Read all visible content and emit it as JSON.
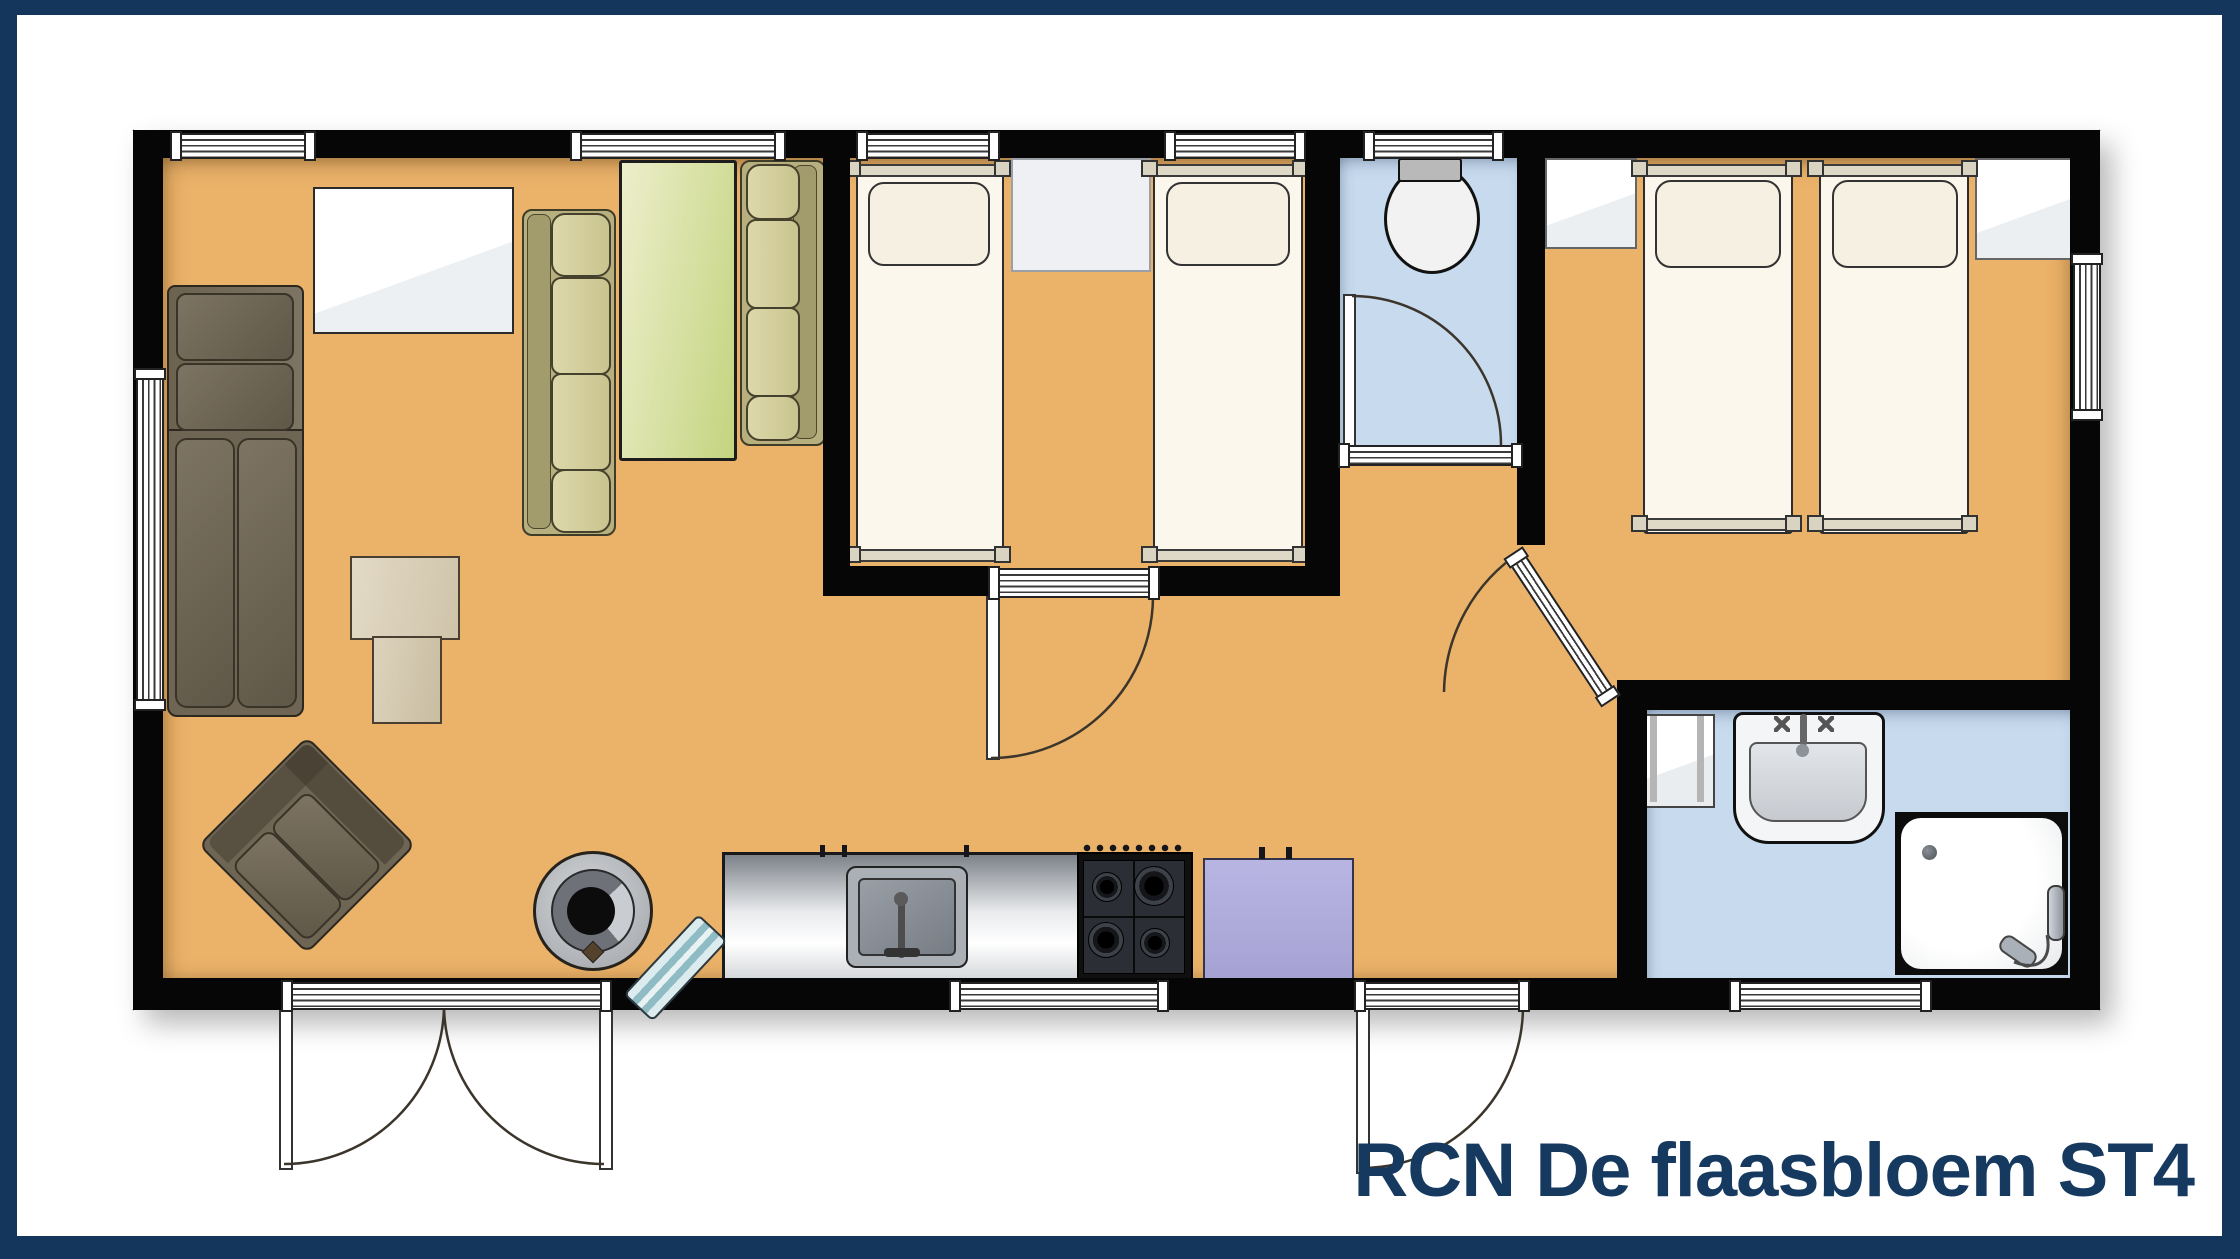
{
  "title": {
    "label": "RCN De flaasbloem ST4"
  },
  "colors": {
    "frame_navy": "#14365c",
    "title_navy": "#15395f",
    "wall_black": "#060606",
    "floor_orange": "#ebb269",
    "wetroom_blue": "#c7daee",
    "sofa_olive": "#b7b07e",
    "sofa_brown": "#6e6554",
    "dinette_green_light": "#edeecb",
    "dinette_green_dark": "#c3d47f",
    "appliance_purple": "#b9b5e3",
    "bed_white": "#fbf7ed"
  },
  "plan": {
    "type": "holiday-chalet-floor-plan",
    "rooms": [
      {
        "name": "living-room",
        "floor": "orange",
        "furniture": [
          "corner-sofa",
          "armchair",
          "coffee-table",
          "sideboard",
          "dinette-sofa",
          "dinette-table",
          "dinette-sofa",
          "wood-stove",
          "bench"
        ]
      },
      {
        "name": "kitchen",
        "floor": "orange",
        "furniture": [
          "counter-with-sink",
          "gas-hob",
          "appliance"
        ]
      },
      {
        "name": "bedroom-1",
        "floor": "orange",
        "furniture": [
          "single-bed",
          "nightstand",
          "single-bed"
        ]
      },
      {
        "name": "toilet-room",
        "floor": "blue",
        "fixtures": [
          "toilet"
        ]
      },
      {
        "name": "bedroom-2",
        "floor": "orange",
        "furniture": [
          "wardrobe",
          "single-bed",
          "single-bed",
          "wardrobe"
        ]
      },
      {
        "name": "bathroom",
        "floor": "blue",
        "fixtures": [
          "mirror-cabinet",
          "washbasin",
          "shower-tray",
          "hand-shower"
        ]
      }
    ],
    "openings": [
      "french-doors-south",
      "entrance-door-south",
      "bedroom-1-door",
      "toilet-door",
      "bedroom-2-door",
      "windows"
    ]
  }
}
